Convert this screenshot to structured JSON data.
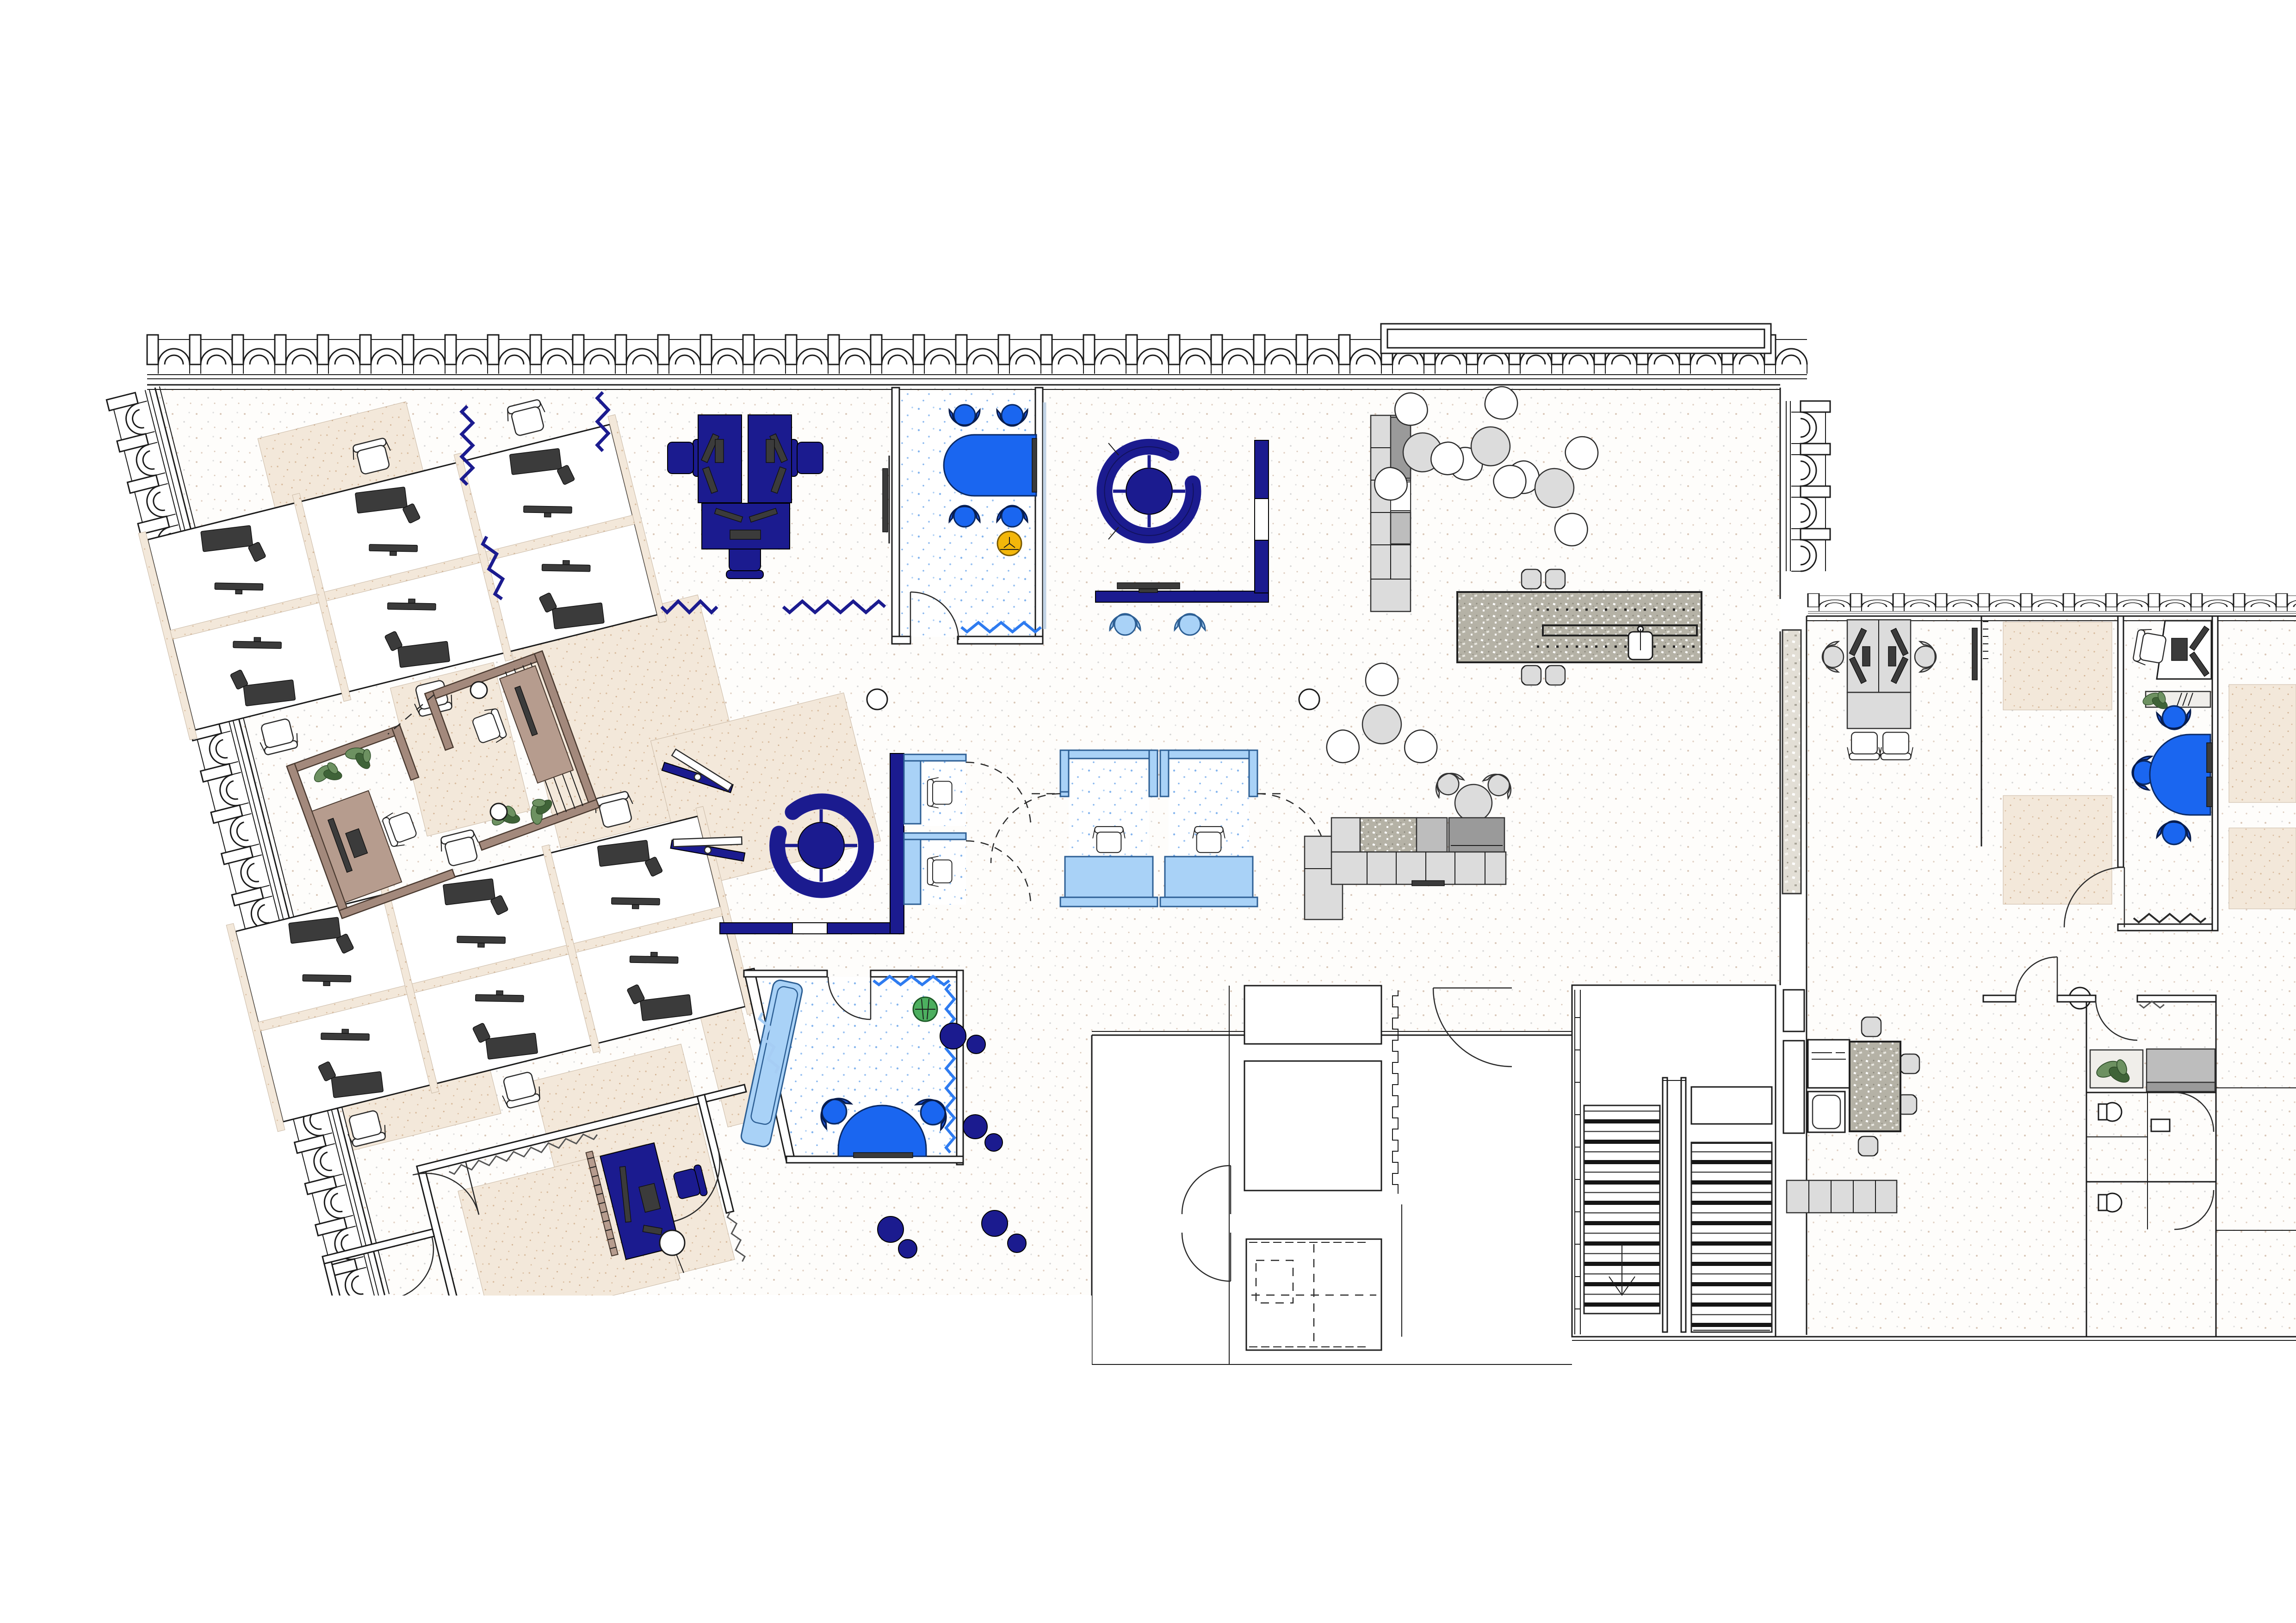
{
  "title": "Office floor plan",
  "document_type": "architectural-floor-plan",
  "visible_text": [],
  "colors": {
    "line": "#1c1c1c",
    "navy": "#1b1b8f",
    "royal": "#1a66f0",
    "royalChair": "#2157d8",
    "lightBlue": "#a9d2f7",
    "blueZig": "#2e7bf0",
    "paleZig": "#a6cdf4",
    "beigeBase": "#f3e8da",
    "beigeDot": "#d8bb9d",
    "wood": "#a3897c",
    "woodLight": "#b69c8e",
    "gray1": "#dcdcdc",
    "gray2": "#bdbdbd",
    "gray3": "#9a9a9a",
    "dark": "#3b3b3b",
    "granite": "#b5b2a6",
    "terrazzo": "#e2ded5",
    "yellow": "#f3b70a",
    "green": "#4caf5f",
    "plant": "#6d9161",
    "floorDotWarm": "#d9c7b8",
    "floorDotCool": "#d6d6d6",
    "blueFloorDot": "#85b5ee"
  },
  "zones": [
    "arched-facade-bays",
    "open-office-bench-cluster-1",
    "open-office-bench-cluster-2",
    "executive-navy-desk-cluster",
    "meeting-room-blue-table",
    "circular-sofa-booth-1",
    "circular-sofa-booth-2",
    "media-wall-with-light-blue-chairs",
    "phone-booth-pair-light-blue-1",
    "phone-booth-pair-light-blue-2",
    "wooden-focus-rooms",
    "blue-lounge-room",
    "bean-bags",
    "shelving-unit",
    "cafe-round-tables",
    "kitchen-island-granite",
    "banquette-counter",
    "terrazzo-counter",
    "stairwell",
    "elevator-core",
    "right-wing-open-office",
    "far-right-private-office",
    "kitchenette",
    "wc-suite",
    "angled-private-room-bottom-left"
  ]
}
